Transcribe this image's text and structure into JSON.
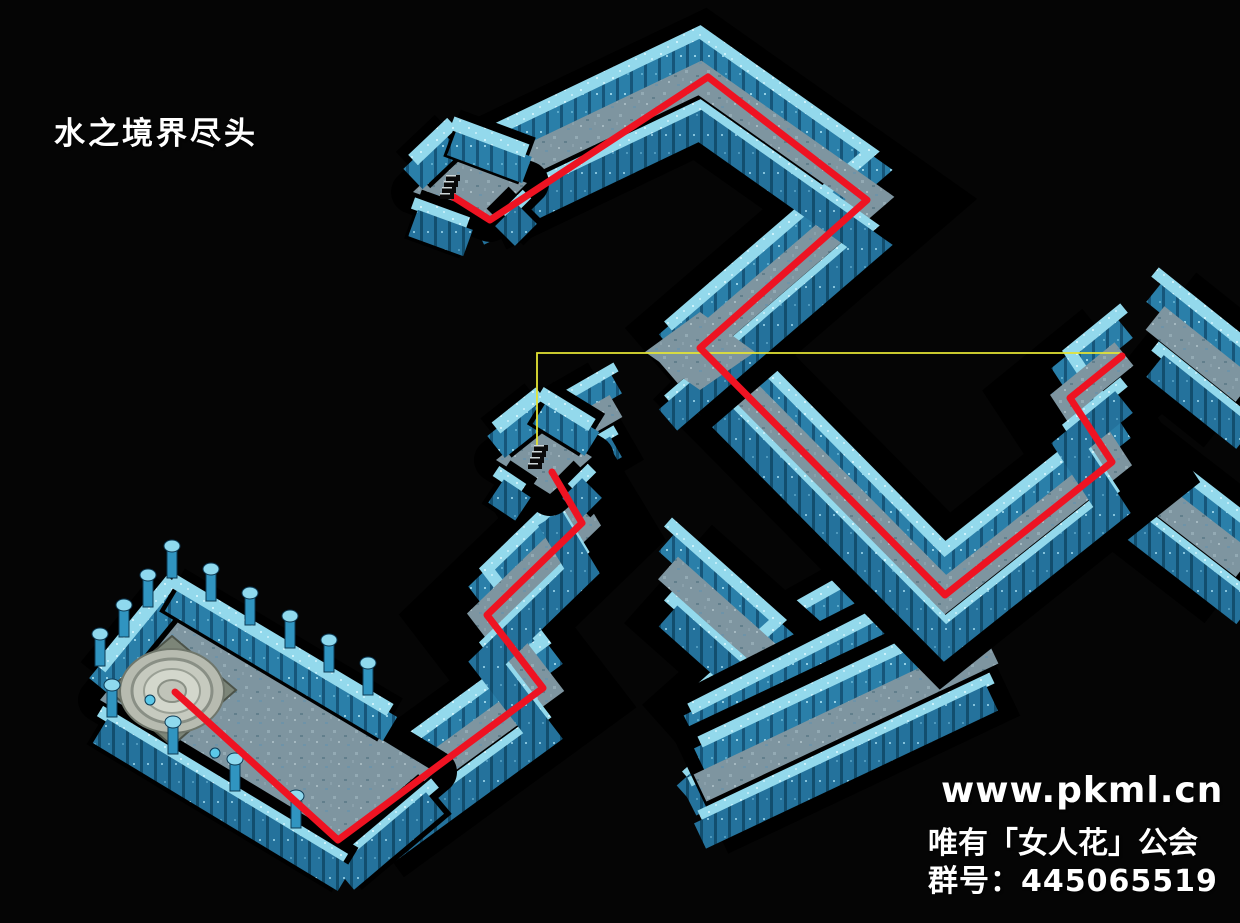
{
  "title": "水之境界尽头",
  "watermark": {
    "line1": "www.pkml.cn",
    "line2": "唯有「女人花」公会",
    "line3": "群号：445065519"
  },
  "map": {
    "background": "#050505",
    "colors": {
      "outline": "#000000",
      "wall_face": "#2a7fa9",
      "wall_face_dark": "#24729c",
      "wall_stripe": "#16567a",
      "wall_top_cyan": "#93d9ec",
      "floor": "#7e95a0",
      "route_red": "#ee1322",
      "teleport_yellow": "#e4e435",
      "pillar": "#3094c0",
      "pillar_cap": "#8fd9ee",
      "platform_stone": "#b7bbb0"
    },
    "corridors": [
      {
        "name": "lower-s-branch",
        "points": [
          [
            781,
            662
          ],
          [
            888,
            602
          ]
        ],
        "scale": 1
      },
      {
        "name": "lower-s-zigzag",
        "points": [
          [
            668,
            568
          ],
          [
            778,
            666
          ],
          [
            686,
            748
          ]
        ],
        "scale": 1
      },
      {
        "name": "lower-u-upper-arm",
        "points": [
          [
            893,
            652
          ],
          [
            690,
            755
          ]
        ],
        "scale": 1
      },
      {
        "name": "lower-u-lower-arm",
        "points": [
          [
            700,
            788
          ],
          [
            992,
            650
          ]
        ],
        "scale": 1
      },
      {
        "name": "right-offmap-upper",
        "points": [
          [
            1155,
            318
          ],
          [
            1245,
            390
          ]
        ],
        "scale": 1
      },
      {
        "name": "right-offmap-lower",
        "points": [
          [
            1112,
            462
          ],
          [
            1245,
            565
          ]
        ],
        "scale": 1
      },
      {
        "name": "main-descent",
        "points": [
          [
            700,
            347
          ],
          [
            945,
            595
          ],
          [
            1112,
            462
          ],
          [
            1070,
            398
          ],
          [
            1124,
            354
          ]
        ],
        "scale": 1
      },
      {
        "name": "top-zigzag",
        "points": [
          [
            478,
            184
          ],
          [
            700,
            78
          ],
          [
            870,
            198
          ],
          [
            668,
            372
          ]
        ],
        "scale": 1
      },
      {
        "name": "mid-room-arm",
        "points": [
          [
            545,
            447
          ],
          [
            616,
            406
          ]
        ],
        "scale": 0.85
      },
      {
        "name": "lower-route",
        "points": [
          [
            550,
            470
          ],
          [
            582,
            523
          ],
          [
            487,
            615
          ],
          [
            543,
            688
          ],
          [
            365,
            818
          ]
        ],
        "scale": 1
      }
    ],
    "floor_patches": [
      {
        "name": "junction-patch",
        "points": [
          [
            700,
            312
          ],
          [
            755,
            352
          ],
          [
            700,
            390
          ],
          [
            645,
            352
          ]
        ]
      }
    ],
    "rooms": [
      {
        "name": "start-room",
        "floor": [
          [
            452,
            155
          ],
          [
            527,
            183
          ],
          [
            490,
            220
          ],
          [
            413,
            192
          ]
        ],
        "upper_edges": [
          [
            [
              413,
              192
            ],
            [
              452,
              155
            ]
          ],
          [
            [
              452,
              155
            ],
            [
              527,
              183
            ]
          ]
        ],
        "lower_edges": [
          [
            [
              527,
              183
            ],
            [
              505,
              205
            ]
          ],
          [
            [
              468,
              212
            ],
            [
              413,
              192
            ]
          ]
        ]
      },
      {
        "name": "mid-stairs-room",
        "floor": [
          [
            540,
            425
          ],
          [
            592,
            457
          ],
          [
            550,
            494
          ],
          [
            496,
            460
          ]
        ],
        "upper_edges": [
          [
            [
              496,
              460
            ],
            [
              540,
              425
            ]
          ],
          [
            [
              540,
              425
            ],
            [
              592,
              457
            ]
          ]
        ],
        "lower_edges": [
          [
            [
              592,
              457
            ],
            [
              572,
              477
            ]
          ],
          [
            [
              523,
              478
            ],
            [
              496,
              460
            ]
          ]
        ]
      },
      {
        "name": "goal-room",
        "floor": [
          [
            172,
            612
          ],
          [
            435,
            772
          ],
          [
            345,
            848
          ],
          [
            100,
            700
          ]
        ],
        "upper_edges": [
          [
            [
              100,
              700
            ],
            [
              172,
              612
            ]
          ],
          [
            [
              172,
              612
            ],
            [
              390,
              742
            ]
          ]
        ],
        "lower_edges": [
          [
            [
              435,
              772
            ],
            [
              345,
              848
            ]
          ],
          [
            [
              345,
              848
            ],
            [
              100,
              700
            ]
          ]
        ]
      }
    ],
    "pillars": [
      [
        100,
        664
      ],
      [
        124,
        635
      ],
      [
        148,
        605
      ],
      [
        172,
        576
      ],
      [
        211,
        599
      ],
      [
        250,
        623
      ],
      [
        290,
        646
      ],
      [
        329,
        670
      ],
      [
        368,
        693
      ],
      [
        296,
        826
      ],
      [
        235,
        789
      ],
      [
        173,
        752
      ],
      [
        112,
        715
      ]
    ],
    "orbs": [
      [
        150,
        700
      ],
      [
        215,
        753
      ]
    ],
    "platform": {
      "cx": 172,
      "cy": 691,
      "slab": [
        [
          172,
          636
        ],
        [
          236,
          690
        ],
        [
          172,
          746
        ],
        [
          108,
          690
        ]
      ]
    },
    "stairs": [
      [
        449,
        187
      ],
      [
        537,
        457
      ]
    ],
    "route": {
      "part1": [
        [
          452,
          196
        ],
        [
          490,
          220
        ],
        [
          708,
          77
        ],
        [
          867,
          200
        ],
        [
          700,
          348
        ],
        [
          945,
          595
        ],
        [
          1112,
          462
        ],
        [
          1070,
          398
        ],
        [
          1122,
          356
        ]
      ],
      "part2": [
        [
          552,
          472
        ],
        [
          582,
          523
        ],
        [
          487,
          615
        ],
        [
          543,
          688
        ],
        [
          338,
          840
        ],
        [
          175,
          692
        ]
      ]
    },
    "teleport_link": [
      [
        537,
        455
      ],
      [
        537,
        353
      ],
      [
        1120,
        353
      ]
    ]
  }
}
